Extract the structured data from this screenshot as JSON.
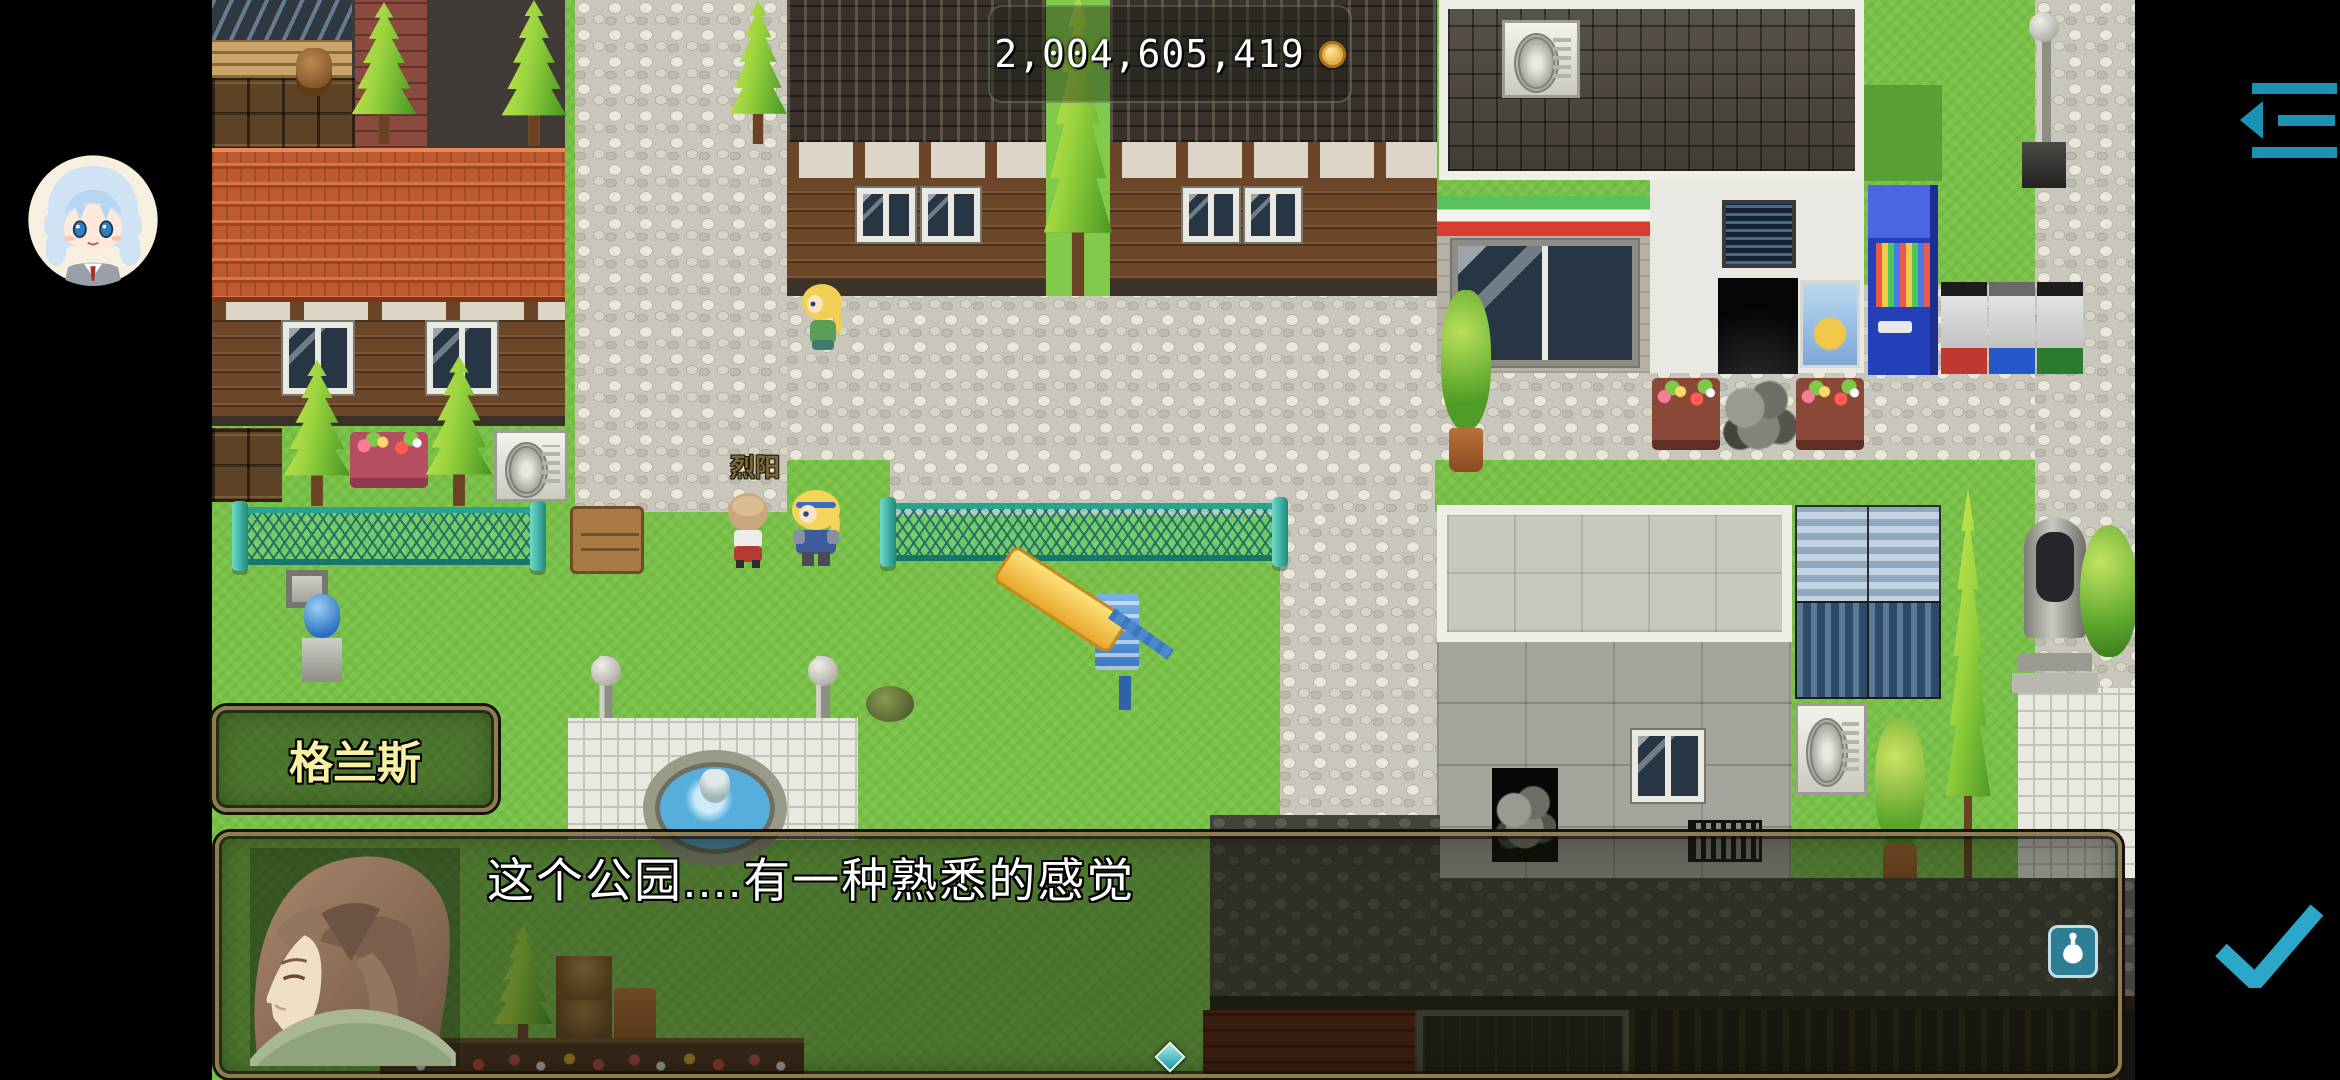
{
  "hud": {
    "currency_value": "2,004,605,419",
    "coin_icon": "gold-coin",
    "avatar_icon": "player-avatar",
    "collapse_icon": "hide-ui-arrow",
    "confirm_icon": "teal-checkmark",
    "item_icon": "potion-flask"
  },
  "dialogue": {
    "speaker_name": "格兰斯",
    "text": "这个公园....有一种熟悉的感觉"
  },
  "map": {
    "npc_label": "烈阳"
  },
  "colors": {
    "accent_teal": "#1f96b4",
    "check_teal": "#2ba7c9",
    "name_text": "#f9f1a2",
    "dialogue_text": "#ffffff",
    "npc_label_text": "#7d6836",
    "window_frame": "#8f7c53"
  }
}
